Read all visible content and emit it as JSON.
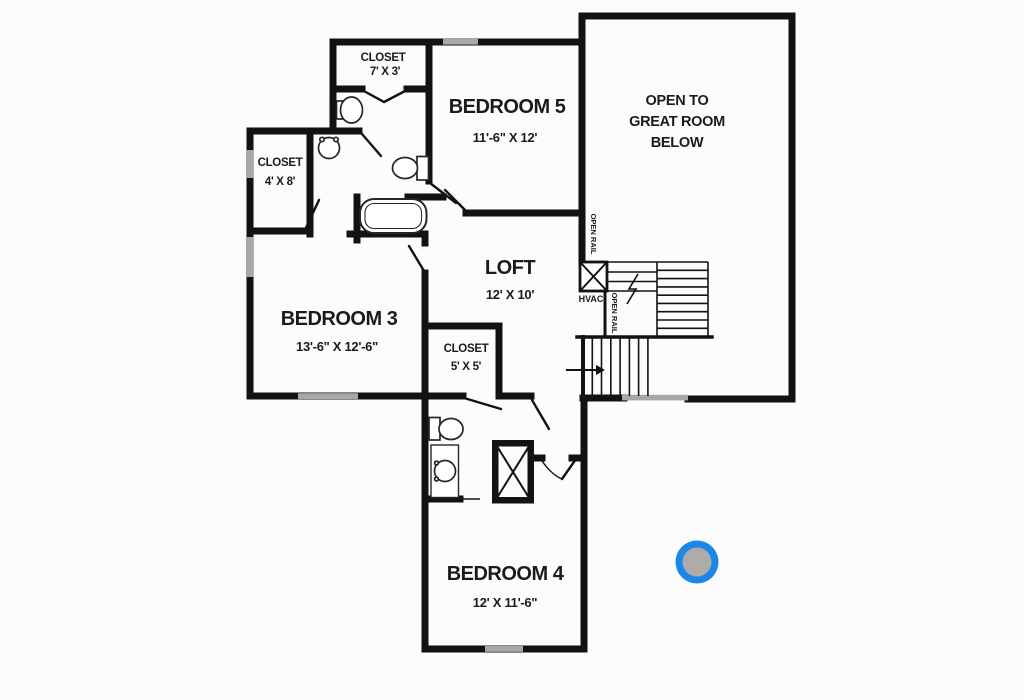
{
  "floor_plan": {
    "rooms": {
      "bedroom5": {
        "name": "BEDROOM 5",
        "dims": "11'-6\" X 12'"
      },
      "bedroom3": {
        "name": "BEDROOM 3",
        "dims": "13'-6\" X 12'-6\""
      },
      "bedroom4": {
        "name": "BEDROOM 4",
        "dims": "12' X 11'-6\""
      },
      "loft": {
        "name": "LOFT",
        "dims": "12' X 10'"
      },
      "closet_top": {
        "name": "CLOSET",
        "dims": "7' X 3'"
      },
      "closet_left": {
        "name": "CLOSET",
        "dims": "4' X 8'"
      },
      "closet_mid": {
        "name": "CLOSET",
        "dims": "5' X 5'"
      }
    },
    "open_area": {
      "line1": "OPEN TO",
      "line2": "GREAT ROOM",
      "line3": "BELOW"
    },
    "labels": {
      "hvac": "HVAC",
      "open_rail_upper": "OPEN RAIL",
      "open_rail_lower": "OPEN RAIL"
    },
    "colors": {
      "background": "#fcfcfc",
      "wall": "#121212",
      "text": "#1b1b1b",
      "window": "#a8a8a8",
      "marker_ring": "#1b87e8",
      "marker_center": "#aeabab"
    }
  }
}
